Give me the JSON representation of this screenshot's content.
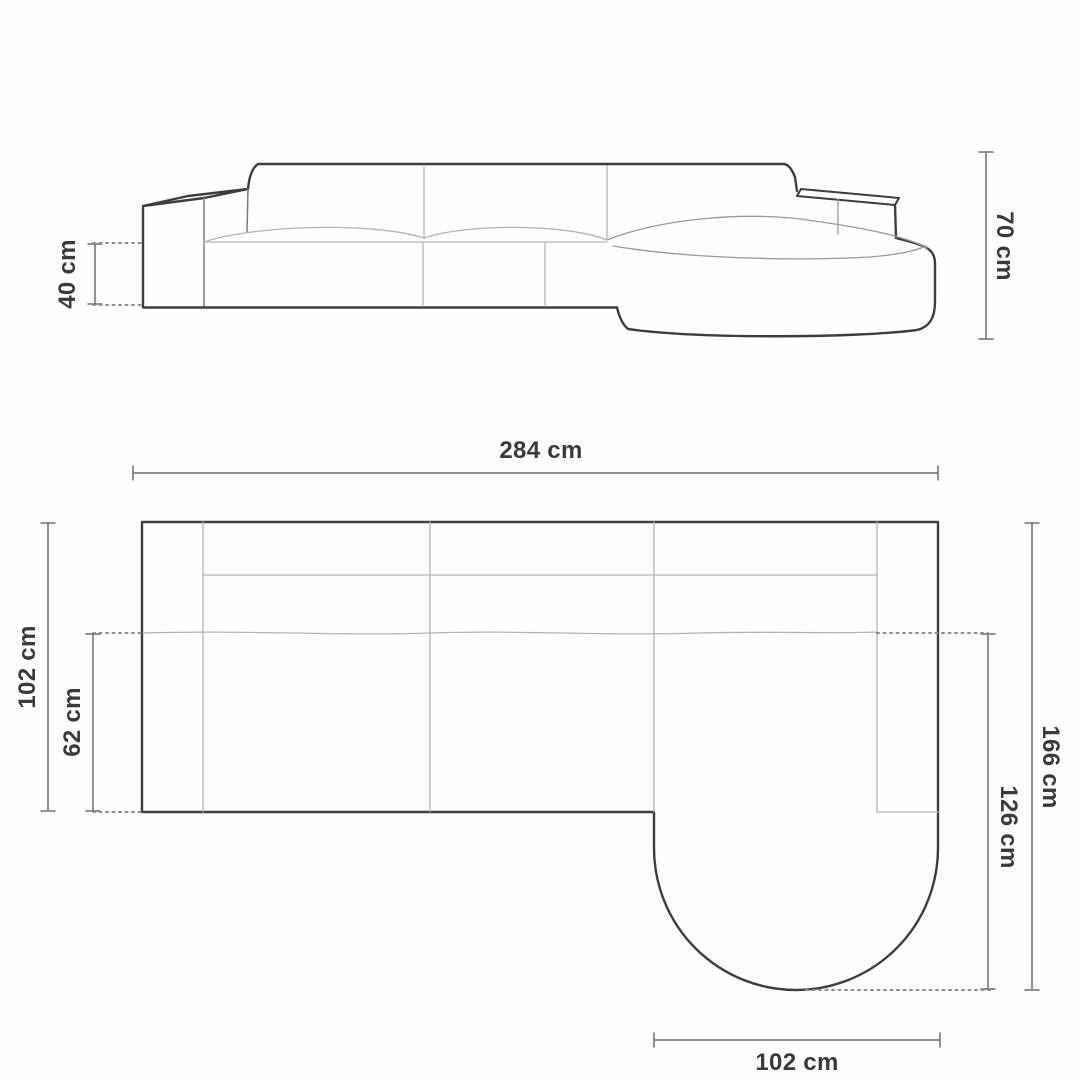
{
  "figure": {
    "type": "furniture-dimension-diagram",
    "subject": "corner sofa with rounded right chaise, front elevation and top plan",
    "unit": "cm",
    "colors": {
      "background": "#fefefe",
      "outline": "#3d3d3d",
      "sketch_light": "#b4b4b4",
      "sketch_medium": "#7d7d7d",
      "dimension_line": "#6e6e6e",
      "label_text": "#3a3a3a"
    }
  },
  "front_view": {
    "dims": {
      "seat_height": {
        "label": "40 cm",
        "value": 40
      },
      "total_height": {
        "label": "70 cm",
        "value": 70
      }
    }
  },
  "top_view": {
    "dims": {
      "total_width": {
        "label": "284 cm",
        "value": 284
      },
      "total_depth": {
        "label": "102 cm",
        "value": 102
      },
      "seat_depth": {
        "label": "62 cm",
        "value": 62
      },
      "chaise_depth_total": {
        "label": "166 cm",
        "value": 166
      },
      "chaise_depth_inner": {
        "label": "126 cm",
        "value": 126
      },
      "chaise_width": {
        "label": "102 cm",
        "value": 102
      }
    }
  }
}
